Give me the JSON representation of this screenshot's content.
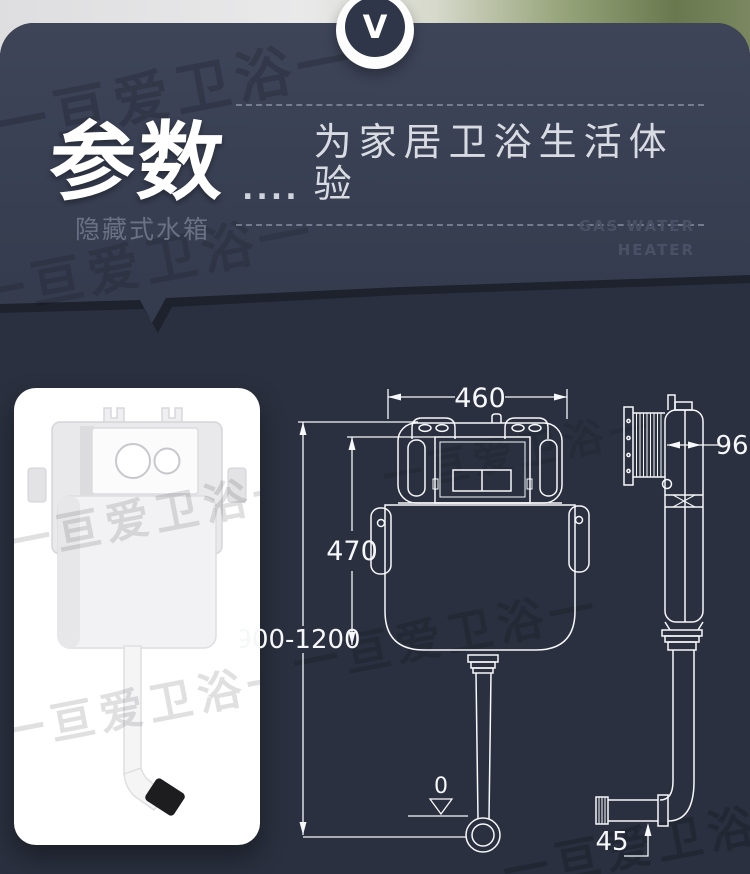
{
  "badge": {
    "letter": "V"
  },
  "header": {
    "title": "参数",
    "tagline_dots": "....",
    "tagline": "为家居卫浴生活体验",
    "product_label": "隐藏式水箱",
    "caption_lines": [
      "GAS WATER",
      "HEATER"
    ]
  },
  "watermark": {
    "text": "一亘爱卫浴一"
  },
  "diagram": {
    "front_view": {
      "width_mm": "460",
      "body_height_mm": "470",
      "install_height_mm": "900-1200",
      "floor_datum": "0"
    },
    "side_view": {
      "depth_mm": "96",
      "outlet_height_mm": "45"
    }
  },
  "colors": {
    "panel_navy": "#2a303f",
    "header_navy": "#3a4153",
    "drawing_line": "#f7f8fa",
    "top_band_gray": "#e4e4e6",
    "top_band_green": "#69784e",
    "card_white": "#ffffff"
  }
}
